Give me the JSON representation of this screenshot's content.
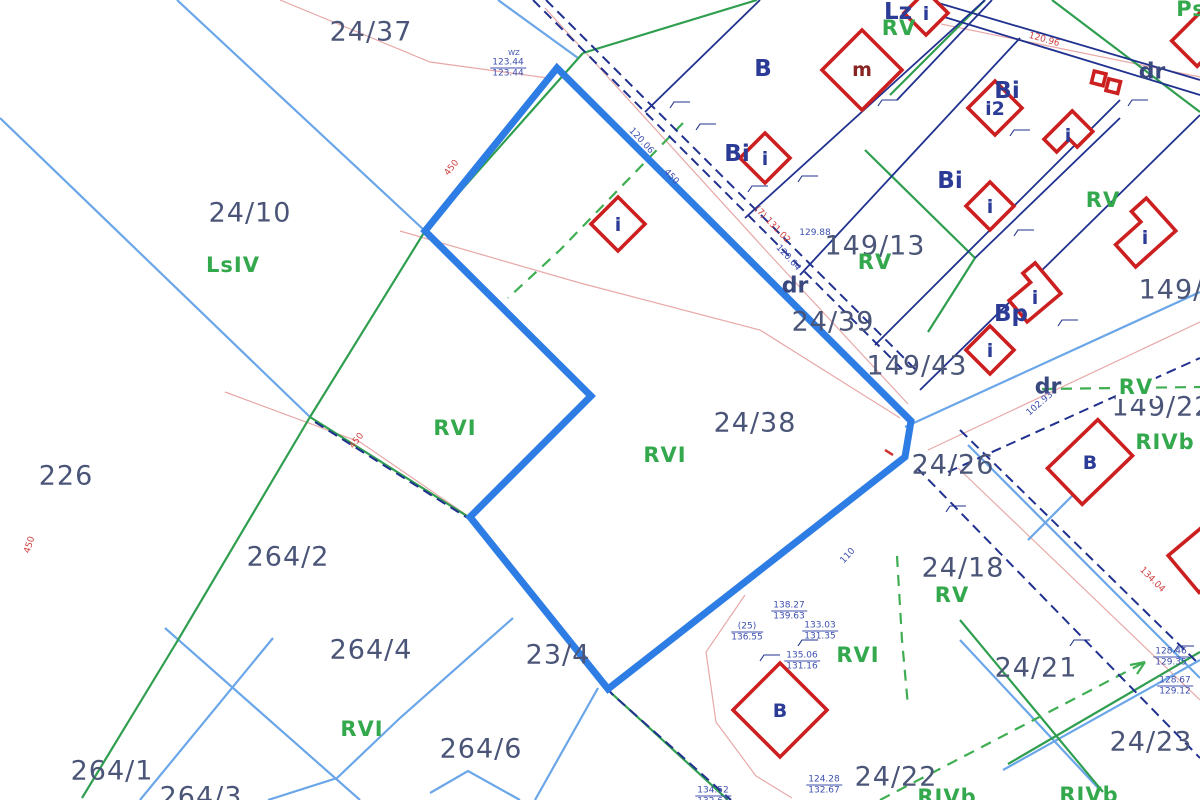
{
  "map": {
    "type": "cadastral-parcel-map",
    "highlighted_parcel": "24/38",
    "colors": {
      "highlight": "#2e7de5",
      "water_lightblue": "#6aa6e8",
      "landuse_green": "#2f9e4f",
      "boundary_navy": "#20318f",
      "contour_pink": "#e8a8a8",
      "building_red": "#cc2020",
      "parcel_text": "#4a5578",
      "landuse_text": "#33a84d",
      "zone_text": "#2c3c96"
    },
    "parcel_labels": [
      {
        "text": "24/37",
        "x": 371,
        "y": 32
      },
      {
        "text": "24/10",
        "x": 250,
        "y": 213
      },
      {
        "text": "226",
        "x": 66,
        "y": 476
      },
      {
        "text": "24/38",
        "x": 755,
        "y": 423
      },
      {
        "text": "24/39",
        "x": 833,
        "y": 322
      },
      {
        "text": "149/13",
        "x": 875,
        "y": 246
      },
      {
        "text": "149/43",
        "x": 917,
        "y": 366
      },
      {
        "text": "24/26",
        "x": 953,
        "y": 465
      },
      {
        "text": "149/22",
        "x": 1162,
        "y": 407
      },
      {
        "text": "149/1",
        "x": 1180,
        "y": 290
      },
      {
        "text": "24/18",
        "x": 963,
        "y": 568
      },
      {
        "text": "24/21",
        "x": 1036,
        "y": 668
      },
      {
        "text": "24/23",
        "x": 1151,
        "y": 742
      },
      {
        "text": "24/22",
        "x": 896,
        "y": 777
      },
      {
        "text": "264/2",
        "x": 288,
        "y": 557
      },
      {
        "text": "264/4",
        "x": 371,
        "y": 650
      },
      {
        "text": "264/1",
        "x": 112,
        "y": 771
      },
      {
        "text": "264/3",
        "x": 201,
        "y": 797
      },
      {
        "text": "264/6",
        "x": 481,
        "y": 749
      },
      {
        "text": "23/4",
        "x": 558,
        "y": 655
      }
    ],
    "landuse_labels": [
      {
        "text": "LsIV",
        "x": 233,
        "y": 265
      },
      {
        "text": "RVI",
        "x": 455,
        "y": 428
      },
      {
        "text": "RVI",
        "x": 665,
        "y": 455
      },
      {
        "text": "RV",
        "x": 875,
        "y": 262
      },
      {
        "text": "RV",
        "x": 899,
        "y": 28
      },
      {
        "text": "RV",
        "x": 1103,
        "y": 200
      },
      {
        "text": "RV",
        "x": 1136,
        "y": 387,
        "bg": true
      },
      {
        "text": "RIVb",
        "x": 1165,
        "y": 442
      },
      {
        "text": "RV",
        "x": 952,
        "y": 595
      },
      {
        "text": "RVI",
        "x": 858,
        "y": 655
      },
      {
        "text": "RVI",
        "x": 362,
        "y": 729
      },
      {
        "text": "RIVb",
        "x": 1089,
        "y": 795
      },
      {
        "text": "RIVb",
        "x": 947,
        "y": 797
      },
      {
        "text": "Ps",
        "x": 1191,
        "y": 9
      }
    ],
    "zone_labels": [
      {
        "text": "Lz",
        "x": 898,
        "y": 12
      },
      {
        "text": "B",
        "x": 763,
        "y": 69
      },
      {
        "text": "Bi",
        "x": 737,
        "y": 154
      },
      {
        "text": "Bi",
        "x": 950,
        "y": 181
      },
      {
        "text": "Bi",
        "x": 1007,
        "y": 91
      },
      {
        "text": "Bp",
        "x": 1011,
        "y": 314
      }
    ],
    "road_labels": [
      {
        "text": "dr",
        "x": 795,
        "y": 286
      },
      {
        "text": "dr",
        "x": 1152,
        "y": 72
      },
      {
        "text": "dr",
        "x": 1048,
        "y": 387
      }
    ],
    "building_letters": [
      {
        "text": "i",
        "x": 618,
        "y": 225
      },
      {
        "text": "m",
        "x": 862,
        "y": 70,
        "variant": "m"
      },
      {
        "text": "i",
        "x": 765,
        "y": 159
      },
      {
        "text": "i",
        "x": 926,
        "y": 14
      },
      {
        "text": "i2",
        "x": 995,
        "y": 109
      },
      {
        "text": "i",
        "x": 1068,
        "y": 136
      },
      {
        "text": "i",
        "x": 990,
        "y": 207
      },
      {
        "text": "i",
        "x": 990,
        "y": 351
      },
      {
        "text": "i",
        "x": 1035,
        "y": 298
      },
      {
        "text": "i",
        "x": 1145,
        "y": 238
      },
      {
        "text": "B",
        "x": 1090,
        "y": 463
      },
      {
        "text": "B",
        "x": 780,
        "y": 711
      }
    ],
    "measurement_pairs": [
      {
        "top": "123.44",
        "bottom": "123.44",
        "x": 508,
        "y": 68
      },
      {
        "top": "138.27",
        "bottom": "139.63",
        "x": 789,
        "y": 611
      },
      {
        "top": "(25)",
        "bottom": "136.55",
        "x": 747,
        "y": 632
      },
      {
        "top": "133.03",
        "bottom": "131.35",
        "x": 820,
        "y": 631
      },
      {
        "top": "135.06",
        "bottom": "131.16",
        "x": 802,
        "y": 661
      },
      {
        "top": "124.28",
        "bottom": "132.67",
        "x": 824,
        "y": 785
      },
      {
        "top": "134.52",
        "bottom": "132.61",
        "x": 713,
        "y": 796
      },
      {
        "top": "128.46",
        "bottom": "129.35",
        "x": 1171,
        "y": 657
      },
      {
        "top": "128.67",
        "bottom": "129.12",
        "x": 1175,
        "y": 686
      }
    ],
    "measurement_singles": [
      {
        "text": "129.88",
        "x": 815,
        "y": 233
      },
      {
        "text": "WZ",
        "x": 514,
        "y": 53,
        "tiny": true
      }
    ],
    "road_measurements": [
      {
        "text": "120.06",
        "x": 641,
        "y": 141,
        "rot": 47,
        "color": "blue"
      },
      {
        "text": "450",
        "x": 671,
        "y": 177,
        "rot": 47,
        "color": "blue"
      },
      {
        "text": "120.64",
        "x": 788,
        "y": 258,
        "rot": 47,
        "color": "blue"
      },
      {
        "text": "102.93",
        "x": 1040,
        "y": 404,
        "rot": -41,
        "color": "blue"
      },
      {
        "text": "110",
        "x": 848,
        "y": 556,
        "rot": -48,
        "color": "blue"
      },
      {
        "text": "(7) 131.02",
        "x": 772,
        "y": 225,
        "rot": 46,
        "color": "red"
      },
      {
        "text": "120.96",
        "x": 1044,
        "y": 40,
        "rot": 16,
        "color": "red"
      },
      {
        "text": "134.04",
        "x": 1152,
        "y": 580,
        "rot": 45,
        "color": "red"
      },
      {
        "text": "450",
        "x": 452,
        "y": 168,
        "rot": -52,
        "color": "red"
      },
      {
        "text": "450",
        "x": 30,
        "y": 545,
        "rot": -72,
        "color": "red"
      },
      {
        "text": "450",
        "x": 357,
        "y": 441,
        "rot": -52,
        "color": "red"
      }
    ]
  }
}
